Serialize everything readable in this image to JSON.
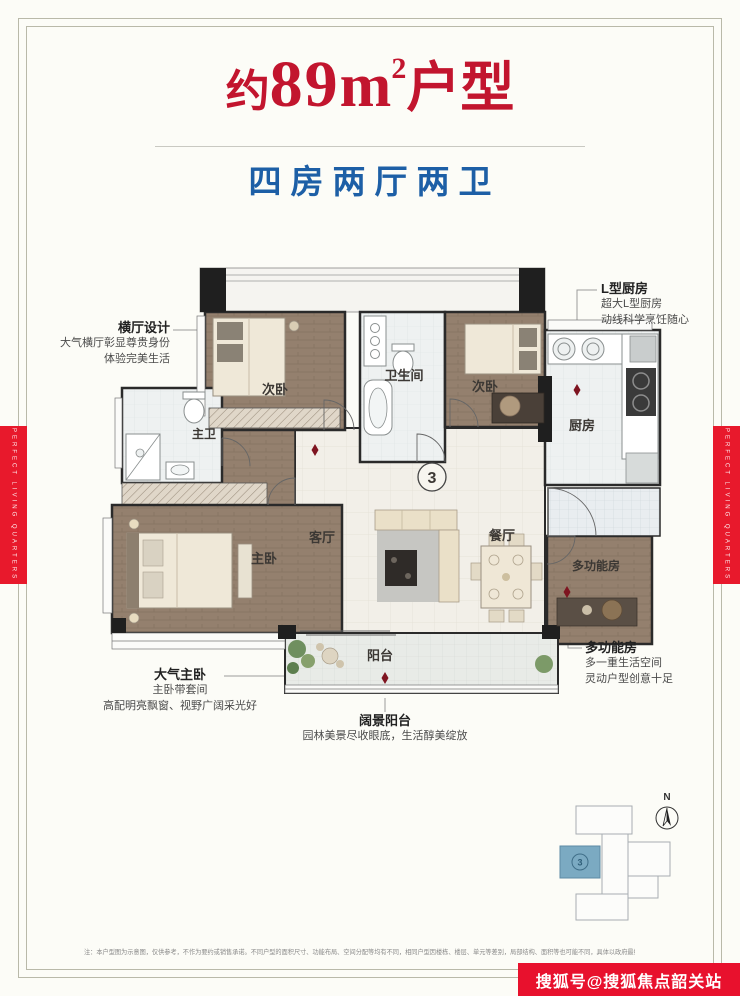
{
  "header": {
    "title_prefix": "约",
    "title_number": "89",
    "title_unit": "m",
    "title_sup": "2",
    "title_suffix": "户型",
    "subtitle": "四房两厅两卫"
  },
  "callouts": {
    "hall": {
      "title": "横厅设计",
      "line1": "大气横厅彰显尊贵身份",
      "line2": "体验完美生活"
    },
    "kitchen": {
      "title": "L型厨房",
      "line1": "超大L型厨房",
      "line2": "动线科学烹饪随心"
    },
    "master": {
      "title": "大气主卧",
      "line1": "主卧带套间",
      "line2": "高配明亮飘窗、视野广阔采光好"
    },
    "balcony": {
      "title": "阔景阳台",
      "line1": "园林美景尽收眼底，生活醇美绽放"
    },
    "multi": {
      "title": "多功能房",
      "line1": "多一重生活空间",
      "line2": "灵动户型创意十足"
    }
  },
  "floorplan": {
    "rooms": {
      "bedroom_a": "次卧",
      "bathroom": "卫生间",
      "bedroom_b": "次卧",
      "kitchen": "厨房",
      "master_bath": "主卫",
      "master_bedroom": "主卧",
      "living": "客厅",
      "dining": "餐厅",
      "multi_room": "多功能房",
      "balcony": "阳台"
    },
    "unit_number": "3"
  },
  "site_plan": {
    "north_label": "N",
    "unit_number": "3"
  },
  "side_banner": "PERFECT LIVING QUARTERS",
  "watermark": "搜狐号@搜狐焦点韶关站",
  "disclaimer": "注：本户型图为示意图，仅供参考，不作为要约或销售承诺。不同户型的面积尺寸、功能布局、空间分配等均有不同，相同户型因楼栋、楼层、单元等差别，局部结构、面积等也可能不同，具体以政府最终审定的图纸和合同为准。",
  "colors": {
    "title_red": "#c2152e",
    "subtitle_blue": "#1d5fa6",
    "banner_red": "#e8192c",
    "watermark_red": "#e8112d",
    "unit_highlight": "#7baac2",
    "wood_floor": "#94806e",
    "wall": "#1f1f1f"
  }
}
